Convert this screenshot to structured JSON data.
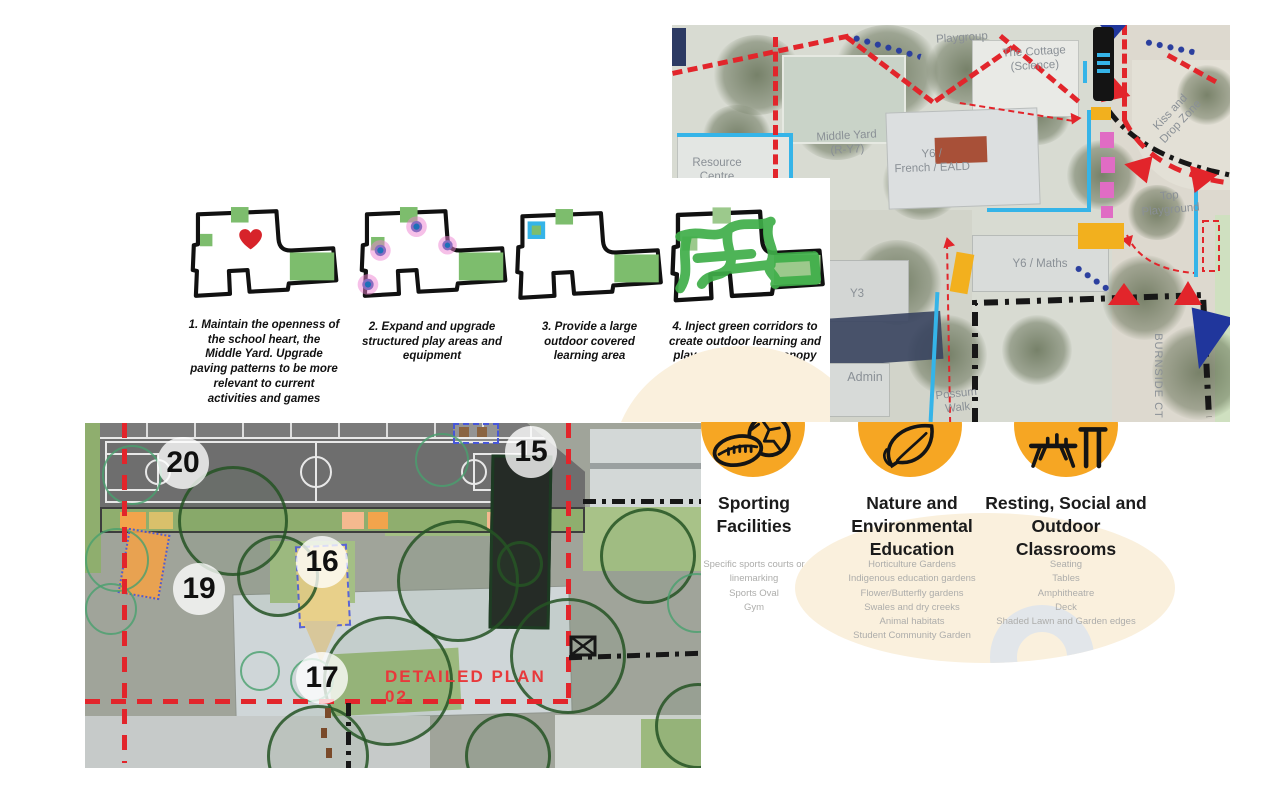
{
  "strategies": [
    {
      "caption": "1. Maintain the openness of the school heart, the Middle Yard.  Upgrade paving patterns to be more relevant to current activities and games"
    },
    {
      "caption": "2. Expand and upgrade structured play areas and equipment"
    },
    {
      "caption": "3. Provide a large outdoor covered learning area"
    },
    {
      "caption": "4. Inject green corridors to create outdoor learning and play spaces. Plant canopy trees throughout the corridor to provide shade and visual amenity"
    }
  ],
  "map": {
    "labels": [
      {
        "id": "playgroup",
        "text": "Playgroup"
      },
      {
        "id": "cottage",
        "text": "The Cottage\n(Science)"
      },
      {
        "id": "middle-yard",
        "text": "Middle Yard\n(R-Y7)"
      },
      {
        "id": "resource",
        "text": "Resource\nCentre"
      },
      {
        "id": "y6-french",
        "text": "Y6 /\nFrench / EALD"
      },
      {
        "id": "y6-maths",
        "text": "Y6 / Maths"
      },
      {
        "id": "y3",
        "text": "Y3"
      },
      {
        "id": "admin",
        "text": "Admin"
      },
      {
        "id": "possum-walk",
        "text": "Possum\nWalk"
      },
      {
        "id": "kiss-drop",
        "text": "Kiss and\nDrop Zone"
      },
      {
        "id": "top-playground",
        "text": "Top\nPlayground"
      },
      {
        "id": "burnside",
        "text": "BURNSIDE CT"
      }
    ]
  },
  "detail_plan": {
    "label": "DETAILED PLAN 02",
    "markers": [
      "20",
      "19",
      "16",
      "15",
      "17"
    ]
  },
  "categories": [
    {
      "icon": "sports-balls-icon",
      "title": "Sporting Facilities",
      "items": [
        "Specific sports courts or linemarking",
        "Sports Oval",
        "Gym"
      ]
    },
    {
      "icon": "leaf-icon",
      "title": "Nature and Environmental Education",
      "items": [
        "Horticulture Gardens",
        "Indigenous education gardens",
        "Flower/Butterfly gardens",
        "Swales and dry creeks",
        "Animal habitats",
        "Student Community Garden"
      ]
    },
    {
      "icon": "picnic-table-icon",
      "title": "Resting, Social and Outdoor Classrooms",
      "items": [
        "Seating",
        "Tables",
        "Amphitheatre",
        "Deck",
        "Shaded Lawn and Garden edges"
      ]
    }
  ],
  "colors": {
    "accent_red": "#e2252b",
    "accent_yellow": "#f6a623",
    "accent_cyan": "#35b4e8",
    "accent_green": "#7dbd6d",
    "cream": "#faf0dd"
  }
}
